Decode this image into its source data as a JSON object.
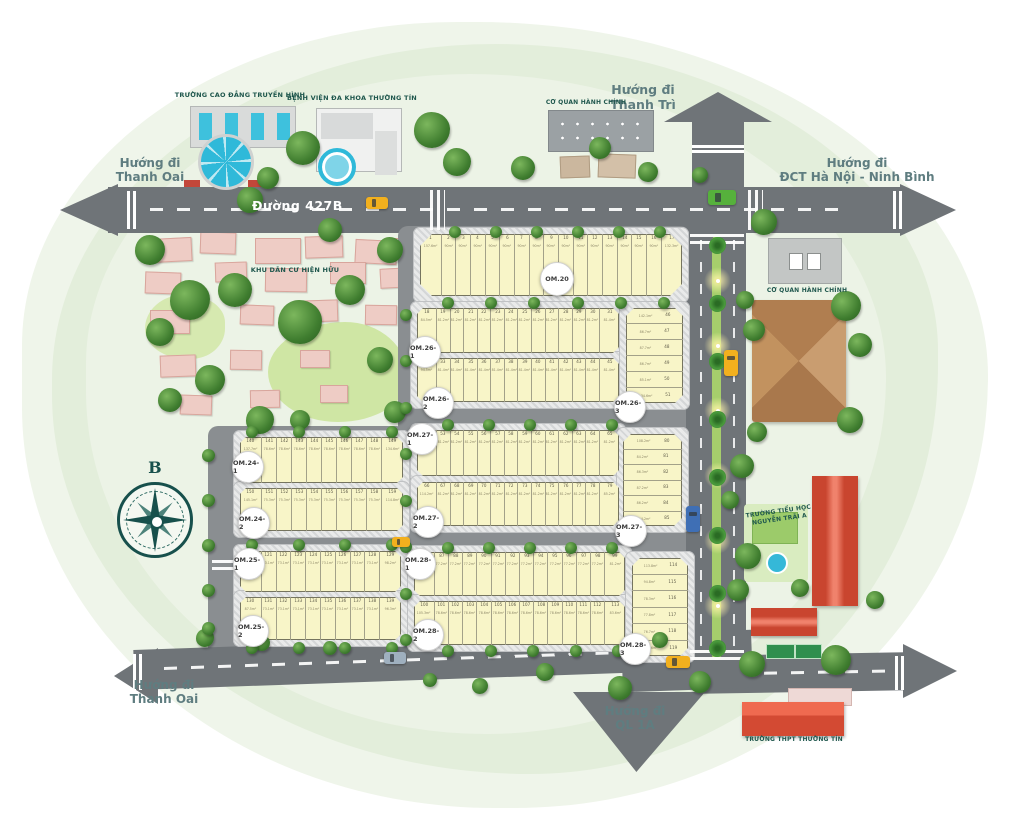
{
  "map": {
    "road_main_label": "Đường 427B",
    "compass_letter": "B",
    "directions": {
      "top_left": "Hướng đi\nThanh Oai",
      "top": "Hướng đi\nThanh Trì",
      "top_right": "Hướng đi\nĐCT Hà Nội - Ninh Bình",
      "bottom_left": "Hướng đi\nThanh Oai",
      "bottom": "Hướng đi\nQL 1A"
    },
    "facilities": {
      "college": "TRƯỜNG CAO ĐẲNG TRUYỀN HÌNH",
      "hospital": "BỆNH VIỆN ĐA KHOA THƯỜNG TÍN",
      "admin_top": "CƠ QUAN HÀNH CHÍNH",
      "admin_right": "CƠ QUAN HÀNH CHÍNH",
      "existing_residential": "KHU DÂN CƯ HIỆN HỮU",
      "primary_school": "TRƯỜNG TIỂU HỌC\nNGUYỄN TRÃI A",
      "high_school": "TRƯỜNG THPT THƯỜNG TÍN"
    },
    "badges": [
      "OM.20",
      "OM.26-1",
      "OM.26-2",
      "OM.26-3",
      "OM.27-1",
      "OM.27-2",
      "OM.27-3",
      "OM.24-1",
      "OM.24-2",
      "OM.25-1",
      "OM.25-2",
      "OM.28-1",
      "OM.28-2",
      "OM.28-3"
    ],
    "blocks": [
      {
        "id": "om20",
        "rows": [
          {
            "dir": "h",
            "start": 1,
            "count": 17,
            "area_first": "157.6m²",
            "area_typical": "90m²",
            "area_last": "132.3m²"
          }
        ]
      },
      {
        "id": "om26",
        "rows": [
          {
            "dir": "h",
            "start": 18,
            "count": 14,
            "area_first": "84.5m²",
            "area_typical": "81.2m²",
            "area_last": "81.4m²"
          },
          {
            "dir": "h",
            "start": 32,
            "count": 14,
            "area_first": "94.5m²",
            "area_typical": "81.4m²",
            "area_last": "81.4m²"
          },
          {
            "dir": "v",
            "start": 46,
            "count": 6,
            "areas": [
              "142.1m²",
              "86.7m²",
              "87.7m²",
              "86.7m²",
              "85.1m²",
              "134.6m²"
            ]
          }
        ]
      },
      {
        "id": "om27",
        "rows": [
          {
            "dir": "h",
            "start": 52,
            "count": 14,
            "area_first": "108.7m²",
            "area_typical": "81.2m²",
            "area_last": "81.2m²"
          },
          {
            "dir": "h",
            "start": 66,
            "count": 14,
            "area_first": "114.2m²",
            "area_typical": "81.2m²",
            "area_last": "85.2m²"
          },
          {
            "dir": "v",
            "start": 80,
            "count": 6,
            "areas": [
              "108.2m²",
              "84.2m²",
              "86.3m²",
              "87.2m²",
              "86.2m²",
              "114.2m²"
            ]
          }
        ]
      },
      {
        "id": "om28",
        "rows": [
          {
            "dir": "h",
            "start": 86,
            "count": 14,
            "area_first": "123.8m²",
            "area_typical": "77.2m²",
            "area_last": "81.2m²"
          },
          {
            "dir": "h",
            "start": 100,
            "count": 14,
            "area_first": "105.3m²",
            "area_typical": "78.6m²",
            "area_last": "83.6m²"
          },
          {
            "dir": "v",
            "start": 114,
            "count": 6,
            "areas": [
              "113.8m²",
              "94.8m²",
              "78.3m²",
              "77.8m²",
              "76.7m²",
              "129.6m²"
            ]
          }
        ]
      },
      {
        "id": "om24",
        "rows": [
          {
            "dir": "h",
            "start": 140,
            "count": 10,
            "area_first": "137.7m²",
            "area_typical": "78.6m²",
            "area_last": "134.6m²"
          },
          {
            "dir": "h",
            "start": 150,
            "count": 10,
            "area_first": "145.1m²",
            "area_typical": "75.3m²",
            "area_last": "114.8m²"
          }
        ]
      },
      {
        "id": "om25",
        "rows": [
          {
            "dir": "h",
            "start": 120,
            "count": 10,
            "area_first": "85.6m²",
            "area_typical": "73.1m²",
            "area_last": "98.2m²"
          },
          {
            "dir": "h",
            "start": 130,
            "count": 10,
            "area_first": "87.5m²",
            "area_typical": "73.1m²",
            "area_last": "96.3m²"
          }
        ]
      }
    ],
    "colors": {
      "road": "#6f7478",
      "street": "#8a8e91",
      "plot_fill": "#f8f5c8",
      "median_green": "#a6ce6c",
      "label_teal": "#5f7d80",
      "facility_teal": "#1f574d",
      "school_red": "#e2523a",
      "roof_brown": "#bb8a5c",
      "pool_blue": "#2fb9d9",
      "compass_teal": "#17504c"
    }
  }
}
